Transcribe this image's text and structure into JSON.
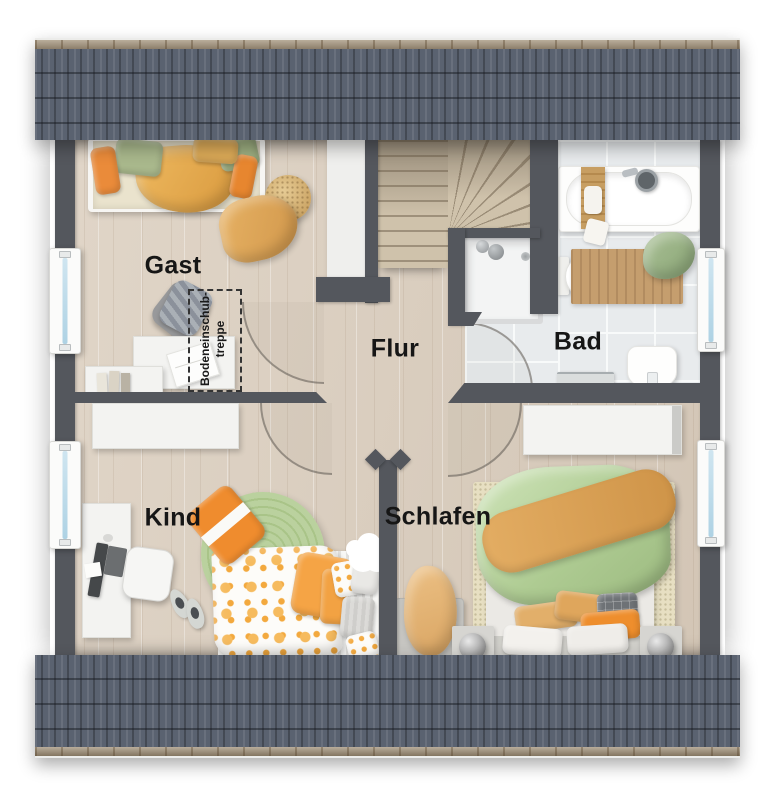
{
  "rooms": {
    "gast": {
      "label": "Gast"
    },
    "flur": {
      "label": "Flur"
    },
    "bad": {
      "label": "Bad"
    },
    "kind": {
      "label": "Kind"
    },
    "schlafen": {
      "label": "Schlafen"
    }
  },
  "annotations": {
    "attic_ladder": {
      "line1": "Bodeneinschub-",
      "line2": "treppe"
    }
  },
  "palette": {
    "roof": "#5a6270",
    "gutter": "#9f8e75",
    "wall": "#54575d",
    "wood_floor": "#ddd1c2",
    "tile_floor": "#e8ebed",
    "accent_orange": "#ee8e2d",
    "accent_green": "#aecb92",
    "accent_mustard": "#dfa75d",
    "window_glass": "#b8d9ea"
  },
  "elements": {
    "windows": [
      "gast-window",
      "kind-window",
      "bad-window",
      "schlafen-window"
    ],
    "door_swings": [
      "gast-door-swing",
      "kind-door-swing",
      "schlafen-door-swing",
      "bad-door-swing"
    ],
    "stairs": "winder-staircase",
    "furniture": {
      "gast": [
        "single-bed",
        "pouf",
        "throw-blanket",
        "desk",
        "laptop",
        "office-chair",
        "lowboard",
        "books"
      ],
      "bad": [
        "bathtub",
        "bath-caddy",
        "shower",
        "toilet",
        "washbasin",
        "towel-rail",
        "bath-mat",
        "towel"
      ],
      "kind": [
        "sideboard",
        "desk",
        "monitor",
        "desk-chair",
        "round-rug",
        "single-bed",
        "pillows",
        "cloud-shelf",
        "slippers"
      ],
      "schlafen": [
        "wardrobe",
        "double-bed",
        "rug",
        "bench",
        "blanket",
        "nightstands",
        "ball-lamps"
      ]
    }
  }
}
